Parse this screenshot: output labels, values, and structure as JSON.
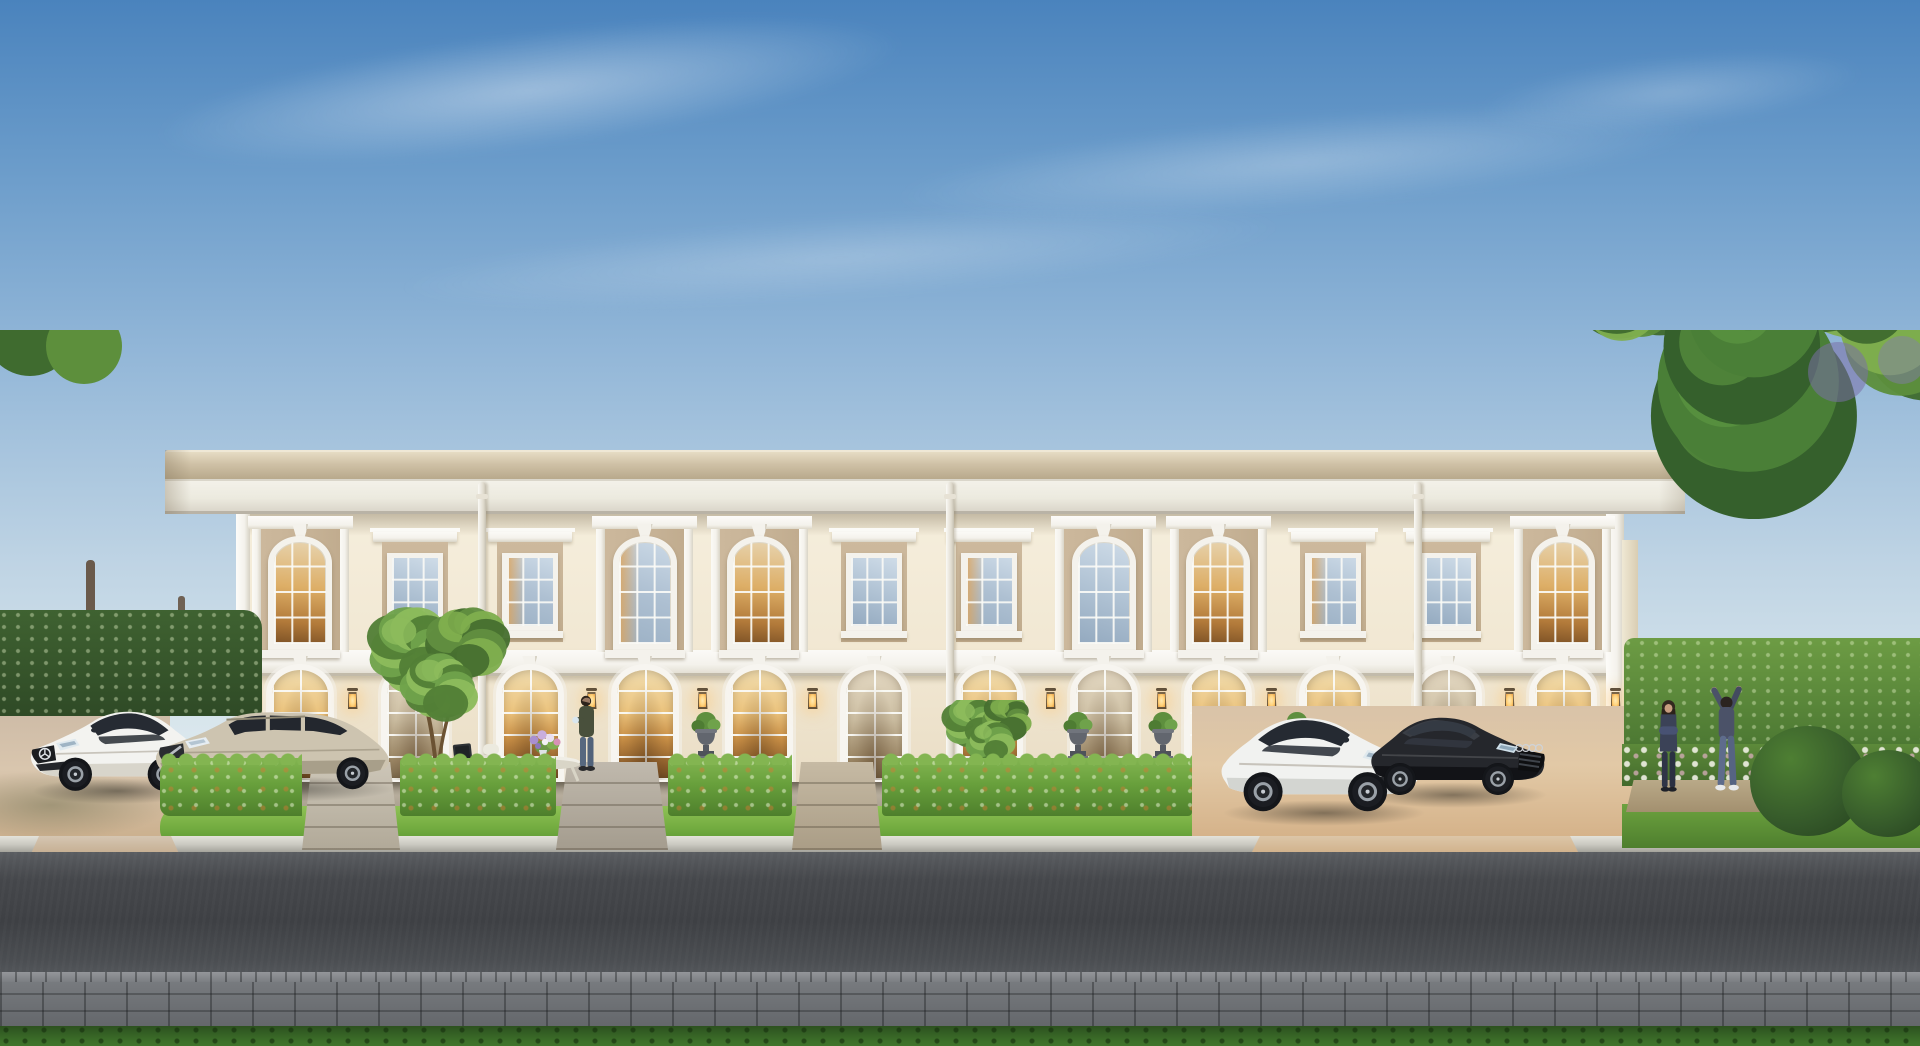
{
  "scene": {
    "kind": "architectural-rendering",
    "subject": "two-storey cream neoclassical townhome row at dusk with parked luxury cars, front gardens, road and flanking trees",
    "size": {
      "w": 1920,
      "h": 1046
    },
    "sky": {
      "stops": [
        "#4a83bd",
        "#6b9cca",
        "#93b7d8",
        "#bfd4e4",
        "#dde9ee",
        "#f0f4f1"
      ],
      "clouds": [
        {
          "x": 140,
          "y": 30,
          "w": 780,
          "h": 120,
          "rot": -7,
          "op": 0.4
        },
        {
          "x": 880,
          "y": 115,
          "w": 840,
          "h": 95,
          "rot": -5,
          "op": 0.28
        },
        {
          "x": 380,
          "y": 215,
          "w": 920,
          "h": 85,
          "rot": -4,
          "op": 0.22
        },
        {
          "x": 1470,
          "y": 55,
          "w": 400,
          "h": 75,
          "rot": -6,
          "op": 0.24
        }
      ]
    },
    "palette": {
      "facade_top": "#f5eedc",
      "facade_mid": "#f1e7d2",
      "facade_low": "#e9ddc5",
      "panel_tan": "#cdb99d",
      "panel_tan_dark": "#bfaa8c",
      "trim": "#f4f2ec",
      "trim_bright": "#fbfaf7",
      "trim_shadow": "#c2bbab",
      "roof_tan_light": "#e6dcc4",
      "roof_tan": "#cfc1a6",
      "roof_tan_dark": "#b8a98c",
      "fascia": "#f4f2ea",
      "fascia_shadow": "#d7d2c6",
      "glass_cool_a": "#cfdce8",
      "glass_cool_b": "#93a9bf",
      "glass_warm_a": "#e7d3ae",
      "glass_warm_b": "#b27a3a",
      "door_warm_a": "#f0dcae",
      "door_warm_b": "#8e5e2c",
      "door_soft_a": "#e3d8c2",
      "door_soft_b": "#7c6a4e",
      "hedge_light": "#83b551",
      "hedge_mid": "#68a03c",
      "hedge_dark": "#4e7f2c",
      "lawn_light": "#8fc256",
      "lawn_mid": "#74ad41",
      "lawn_dark": "#5c9733",
      "leaf_dark": "#3f6b2f",
      "leaf_mid": "#5d8f3c",
      "leaf_light": "#7fae4e",
      "leaf_pale": "#9cc268",
      "pine_dark": "#35602c",
      "pine_mid": "#4a7f37",
      "pine_light": "#5f9a42",
      "trunk": "#5a4430",
      "terrace_a": "#b7ad9c",
      "terrace_b": "#9d9484",
      "driveway_a": "#cbb9a5",
      "driveway_b": "#d9c6ae",
      "driveway_c": "#c8ab87",
      "curb_a": "#e3e2da",
      "curb_b": "#a5a49c",
      "road_a": "#5a5d61",
      "road_b": "#3e4044",
      "road_c": "#55585c",
      "cobble_a": "#797c80",
      "cobble_b": "#64676b",
      "grass_a": "#2c511f",
      "grass_b": "#447a2e",
      "lantern_glow": "#ffd27a"
    },
    "building": {
      "facade": {
        "left": 243,
        "right": 1620,
        "top": 514,
        "base": 786
      },
      "roof": {
        "left": 165,
        "right": 1685,
        "top": 450,
        "fascia_top": 479,
        "bottom": 514
      },
      "floor_band": {
        "top": 650,
        "height": 26
      },
      "bay_count": 12,
      "bays": [
        {
          "type": "arch",
          "interior": "warm"
        },
        {
          "type": "small",
          "interior": "cool"
        },
        {
          "type": "small",
          "interior": "mix"
        },
        {
          "type": "arch",
          "interior": "mix"
        },
        {
          "type": "arch",
          "interior": "warm"
        },
        {
          "type": "small",
          "interior": "cool"
        },
        {
          "type": "small",
          "interior": "mix"
        },
        {
          "type": "arch",
          "interior": "cool"
        },
        {
          "type": "arch",
          "interior": "warm"
        },
        {
          "type": "small",
          "interior": "mix"
        },
        {
          "type": "small",
          "interior": "cool"
        },
        {
          "type": "arch",
          "interior": "warm"
        }
      ],
      "door_glow": [
        "warm",
        "soft",
        "warm",
        "warm",
        "warm",
        "soft",
        "warm",
        "soft",
        "warm",
        "warm",
        "soft",
        "warm"
      ],
      "downspouts": [
        482,
        950,
        1418
      ],
      "lanterns": [
        247,
        352,
        591,
        702,
        812,
        1050,
        1161,
        1271,
        1509,
        1615
      ],
      "door": {
        "top": 664,
        "height": 122,
        "width": 68
      },
      "corner_pilasters": [
        {
          "x": 236,
          "w": 14
        },
        {
          "x": 1606,
          "w": 18
        }
      ]
    },
    "ground": {
      "terrace": {
        "x": 243,
        "y": 782,
        "w": 1377,
        "h": 38
      },
      "hedge": {
        "from": 160,
        "to": 1192,
        "y": 758,
        "h": 58
      },
      "paths": [
        {
          "x": 302,
          "w": 98,
          "tone_a": "#cdc6b8",
          "tone_b": "#b1a998"
        },
        {
          "x": 556,
          "w": 112,
          "tone_a": "#c0b9ad",
          "tone_b": "#a49c8e"
        },
        {
          "x": 792,
          "w": 90,
          "tone_a": "#c6baa4",
          "tone_b": "#aa9d86"
        }
      ],
      "lawn": {
        "x": 160,
        "y": 806,
        "w": 1032,
        "h": 38
      },
      "driveway_left": {
        "x": 0,
        "y": 700,
        "w": 170,
        "h": 154
      },
      "driveway_right": {
        "x": 1192,
        "y": 706,
        "w": 462,
        "h": 148
      },
      "curb": {
        "y": 836,
        "h": 16
      },
      "road": {
        "y": 852,
        "h": 126
      },
      "sidewalk": {
        "y": 978,
        "h": 48
      },
      "grass": {
        "y": 1026,
        "h": 20
      }
    },
    "backdrop": {
      "left_hedge_wall": {
        "x": 0,
        "y": 610,
        "w": 262,
        "h": 106
      },
      "right_hedge_wall": {
        "x": 1624,
        "y": 638,
        "w": 296,
        "h": 132
      },
      "right_flowerbed": {
        "x": 1622,
        "y": 744,
        "w": 298,
        "h": 42
      },
      "right_path": {
        "x": 1626,
        "y": 780,
        "w": 190,
        "h": 32
      },
      "right_lawn": {
        "x": 1622,
        "y": 804,
        "w": 298,
        "h": 44
      },
      "topiary": [
        {
          "x": 1808,
          "y": 726,
          "r": 58
        },
        {
          "x": 1888,
          "y": 750,
          "r": 46
        }
      ],
      "left_canopies": [
        [
          58,
          452,
          128
        ],
        [
          152,
          502,
          112
        ],
        [
          238,
          556,
          88
        ],
        [
          118,
          382,
          95
        ]
      ],
      "right_canopies": [
        [
          1638,
          598,
          76
        ],
        [
          1858,
          542,
          118
        ],
        [
          1916,
          624,
          96
        ]
      ],
      "pine": {
        "cx": 1748,
        "top": 502,
        "h": 258,
        "w": 206
      },
      "ornamental_trees": [
        {
          "cx": 437,
          "top": 606,
          "h": 176,
          "w": 152
        },
        {
          "cx": 988,
          "top": 700,
          "h": 92,
          "w": 96
        }
      ]
    },
    "cars": [
      {
        "name": "mercedes-cla-coupe",
        "style": "coupe",
        "mirror": false,
        "x": 24,
        "y": 698,
        "w": 182,
        "body": "#f3f3f0",
        "lower": "#d8d5cb",
        "glass": "#262b33",
        "grille": "#1b1d20",
        "emblem": "star"
      },
      {
        "name": "volvo-v60-wagon",
        "style": "wagon",
        "mirror": false,
        "x": 150,
        "y": 700,
        "w": 248,
        "body": "#cdc4b0",
        "lower": "#a89f8a",
        "glass": "#23272e",
        "grille": "#2a2d31",
        "emblem": "volvo"
      },
      {
        "name": "mercedes-c-sedan",
        "style": "coupe",
        "mirror": true,
        "x": 1214,
        "y": 702,
        "w": 214,
        "body": "#f1f2f0",
        "lower": "#d3d5d1",
        "glass": "#252a32",
        "grille": "#212428",
        "emblem": "star"
      },
      {
        "name": "audi-a8-black",
        "style": "lux",
        "mirror": true,
        "x": 1350,
        "y": 704,
        "w": 200,
        "body": "#25272c",
        "lower": "#121317",
        "glass": "#343a43",
        "grille": "#0e0f11",
        "emblem": "rings"
      }
    ],
    "people": [
      {
        "name": "man-holding-coffee",
        "x": 572,
        "y": 694,
        "h": 78
      },
      {
        "name": "woman-arms-crossed",
        "x": 1652,
        "y": 698,
        "h": 94
      },
      {
        "name": "man-stretching",
        "x": 1702,
        "y": 686,
        "h": 106
      }
    ],
    "props": {
      "urns": [
        706,
        1078,
        1163,
        1297
      ],
      "cafe_set": {
        "x": 450,
        "y": 720,
        "w": 152,
        "h": 62
      }
    }
  }
}
